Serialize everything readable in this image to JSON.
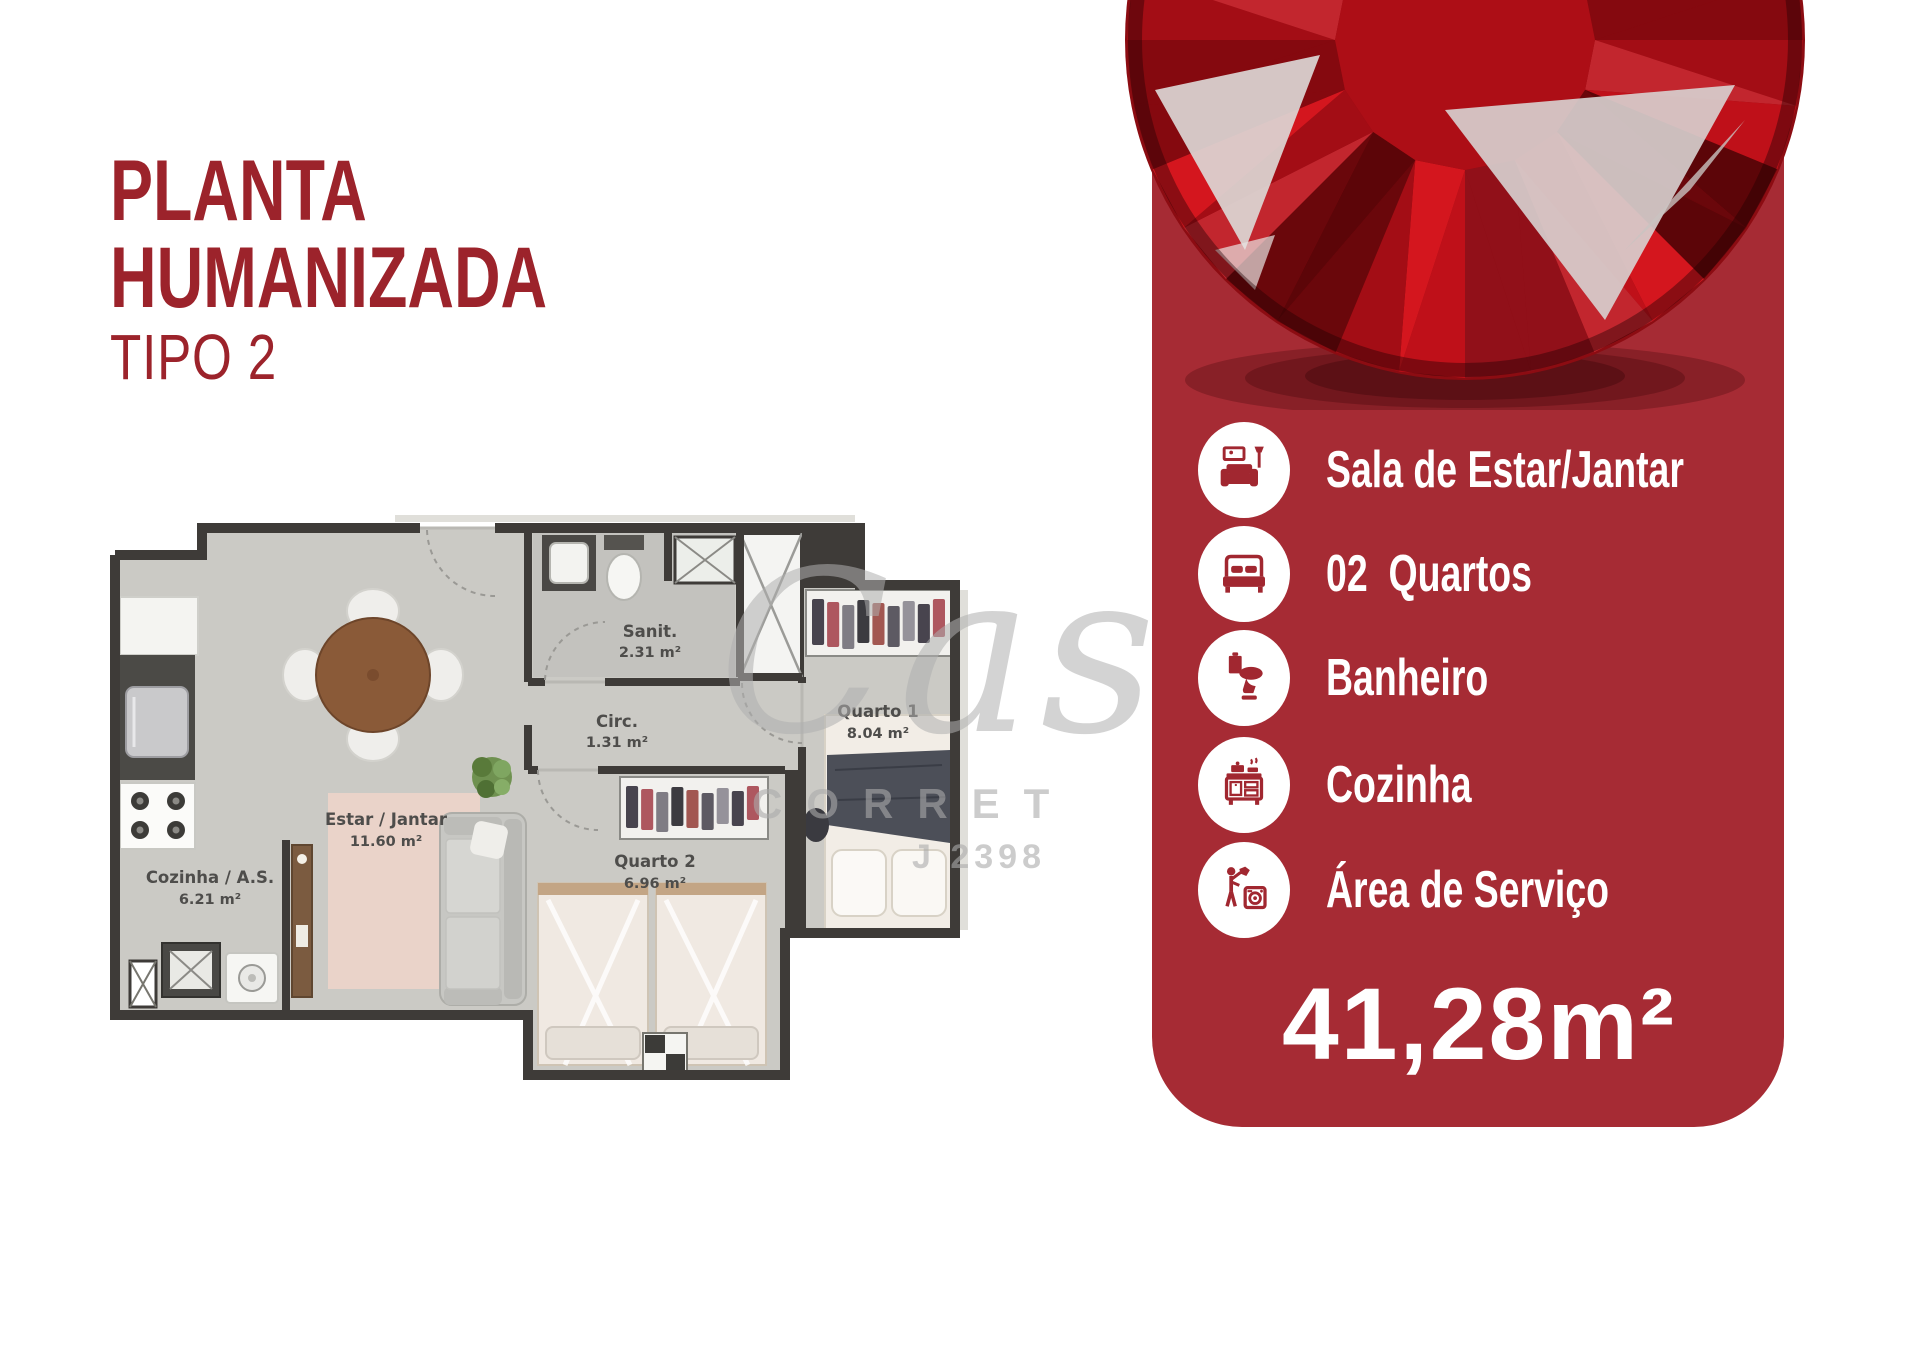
{
  "colors": {
    "brand_red": "#9c232b",
    "panel_red": "#a62b34",
    "gem_red": "#c4121b",
    "watermark_gray": "#b5b5b5"
  },
  "header": {
    "title_line1": "PLANTA",
    "title_line2": "HUMANIZADA",
    "subtitle": "TIPO 2"
  },
  "plan": {
    "rooms": [
      {
        "name": "Cozinha / A.S.",
        "area": "6.21 m²"
      },
      {
        "name": "Estar / Jantar",
        "area": "11.60 m²"
      },
      {
        "name": "Sanit.",
        "area": "2.31 m²"
      },
      {
        "name": "Circ.",
        "area": "1.31 m²"
      },
      {
        "name": "Quarto 2",
        "area": "6.96 m²"
      },
      {
        "name": "Quarto 1",
        "area": "8.04 m²"
      }
    ]
  },
  "watermark": {
    "script": "Cas",
    "line2": "CORRET",
    "line3": "J 2398"
  },
  "panel": {
    "features": [
      {
        "icon": "sofa-icon",
        "label": "Sala de Estar/Jantar"
      },
      {
        "icon": "bed-icon",
        "label": "02  Quartos"
      },
      {
        "icon": "toilet-icon",
        "label": "Banheiro"
      },
      {
        "icon": "stove-icon",
        "label": "Cozinha"
      },
      {
        "icon": "laundry-icon",
        "label": "Área de Serviço"
      }
    ],
    "total_area": "41,28m²"
  }
}
